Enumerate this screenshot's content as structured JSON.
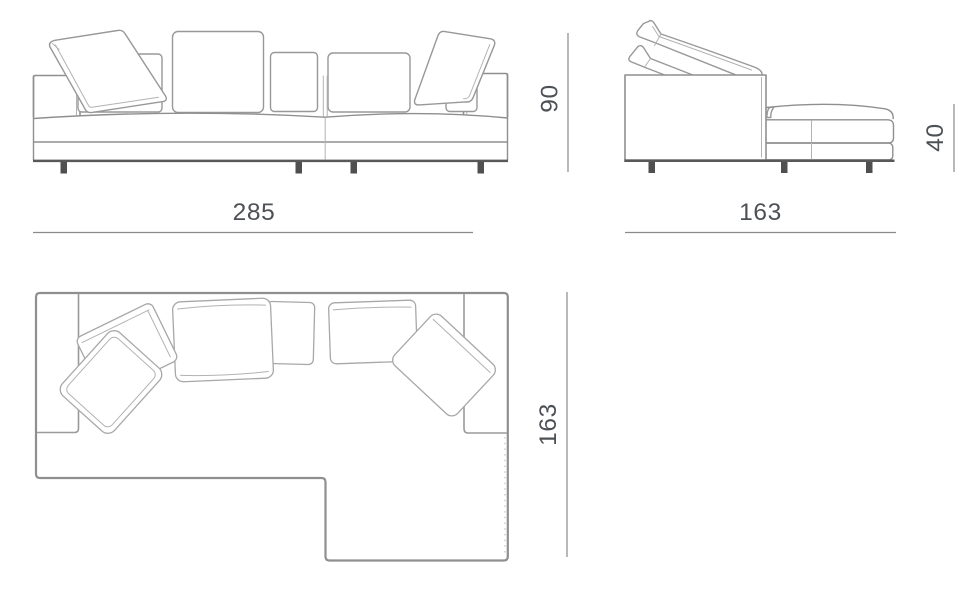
{
  "drawing": {
    "subject": "sectional-sofa-with-chaise-three-view-technical-drawing",
    "background": "#ffffff",
    "views": {
      "front_elevation": {
        "width": {
          "label": "285",
          "orientation": "horizontal"
        },
        "height": {
          "label": "90",
          "orientation": "vertical"
        }
      },
      "side_elevation": {
        "depth": {
          "label": "163",
          "orientation": "horizontal"
        },
        "chaise_height": {
          "label": "40",
          "orientation": "vertical"
        }
      },
      "top_plan": {
        "depth": {
          "label": "163",
          "orientation": "vertical"
        }
      }
    },
    "colors": {
      "outline": "#8f8f8f",
      "cushion_outline": "#a8a8a8",
      "dark_base_rail": "#585858",
      "leg": "#4f4f4f",
      "dimension_line": "#8a8a8a",
      "dimension_text": "#4d5156",
      "background": "#ffffff"
    }
  }
}
